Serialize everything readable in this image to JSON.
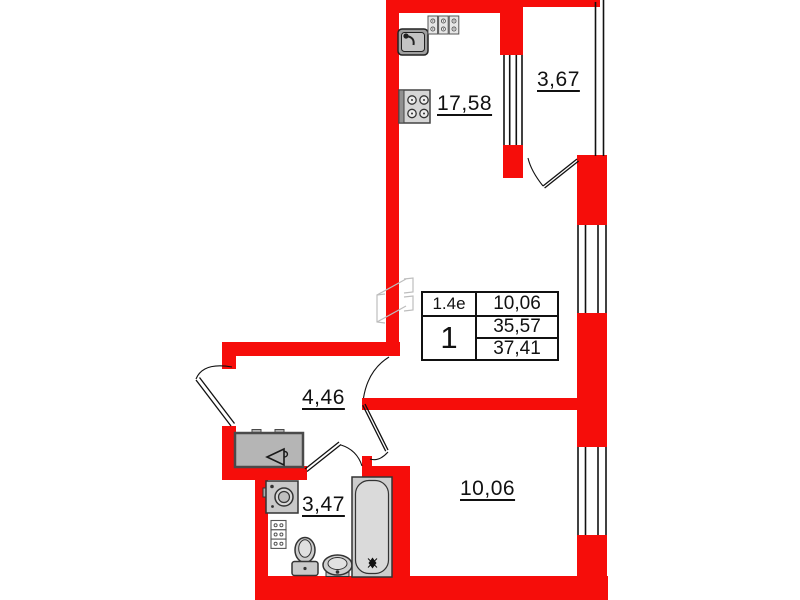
{
  "colors": {
    "wall": "#f60d0a",
    "line": "#111111",
    "fixture_fill": "#c9c9c9",
    "fixture_stroke": "#333333",
    "ghost": "#bdbdbd",
    "text": "#111111"
  },
  "rooms": {
    "kitchen_living": {
      "area": "17,58"
    },
    "balcony": {
      "area": "3,67"
    },
    "hallway": {
      "area": "4,46"
    },
    "bathroom": {
      "area": "3,47"
    },
    "bedroom": {
      "area": "10,06"
    }
  },
  "info_table": {
    "type_code": "1.4е",
    "living_area": "10,06",
    "room_count": "1",
    "area_excl_summer": "35,57",
    "area_total": "37,41"
  },
  "icons": {
    "kitchen_sink": "sink-top-view",
    "hob": "three-burner-block",
    "stove": "four-burner-stove",
    "wardrobe": "wardrobe-with-hanger",
    "washing_machine": "washing-machine-top-view",
    "towel_rail": "stacked-blocks",
    "toilet": "toilet-top-view",
    "bathroom_sink": "oval-sink-top-view",
    "bathtub": "bathtub-top-view"
  }
}
